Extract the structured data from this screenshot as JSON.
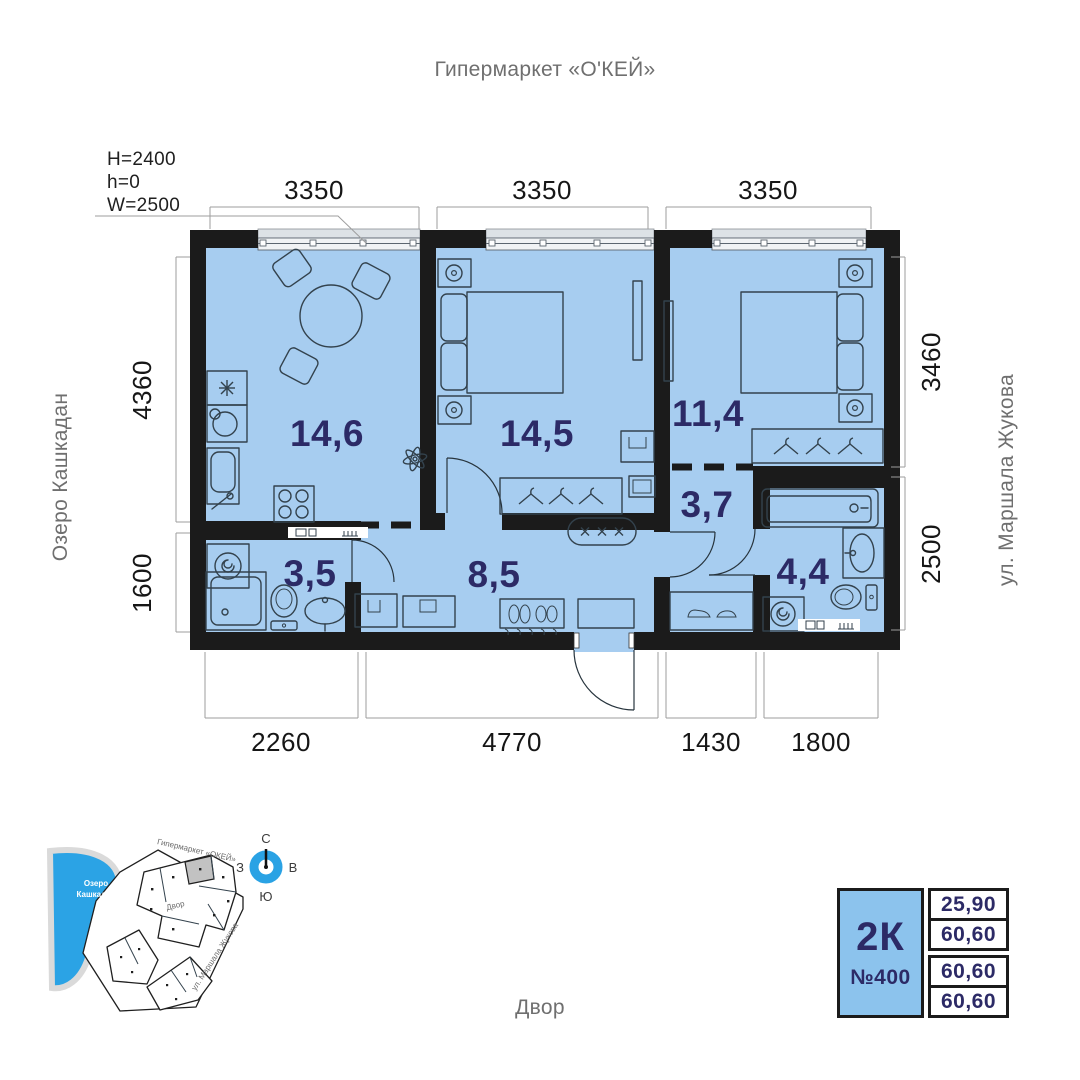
{
  "surroundings": {
    "north_label": "Гипермаркет «О'КЕЙ»",
    "west_label": "Озеро Кашкадан",
    "east_label": "ул. Маршала Жукова",
    "south_label": "Двор"
  },
  "window_spec": {
    "height": "H=2400",
    "sill": "h=0",
    "width": "W=2500"
  },
  "dims": {
    "top": [
      "3350",
      "3350",
      "3350"
    ],
    "left": [
      "4360",
      "1600"
    ],
    "right": [
      "3460",
      "2500"
    ],
    "bottom": [
      "2260",
      "4770",
      "1430",
      "1800"
    ]
  },
  "rooms": {
    "kitchen_living": "14,6",
    "bedroom_1": "14,5",
    "bedroom_2": "11,4",
    "hallway": "3,7",
    "bathroom_2": "4,4",
    "corridor": "8,5",
    "bathroom_1": "3,5"
  },
  "info_card": {
    "type": "2К",
    "number": "№400",
    "area_rows": [
      "25,90",
      "60,60",
      "60,60",
      "60,60"
    ]
  },
  "compass": {
    "north": "С",
    "south": "Ю",
    "west": "З",
    "east": "В"
  },
  "minimap": {
    "lake_label_line1": "Озеро",
    "lake_label_line2": "Кашкадан",
    "hypermarket_label": "Гипермаркет «ОКЕЙ»",
    "yard_label": "Двор",
    "street_label": "ул. Маршала Жукова"
  },
  "colors": {
    "floor": "#a7cdf0",
    "wall": "#1b1b1b",
    "accent_text": "#2c2a66",
    "map_blue": "#2ba3e5",
    "card_blue": "#8cc3ed"
  }
}
